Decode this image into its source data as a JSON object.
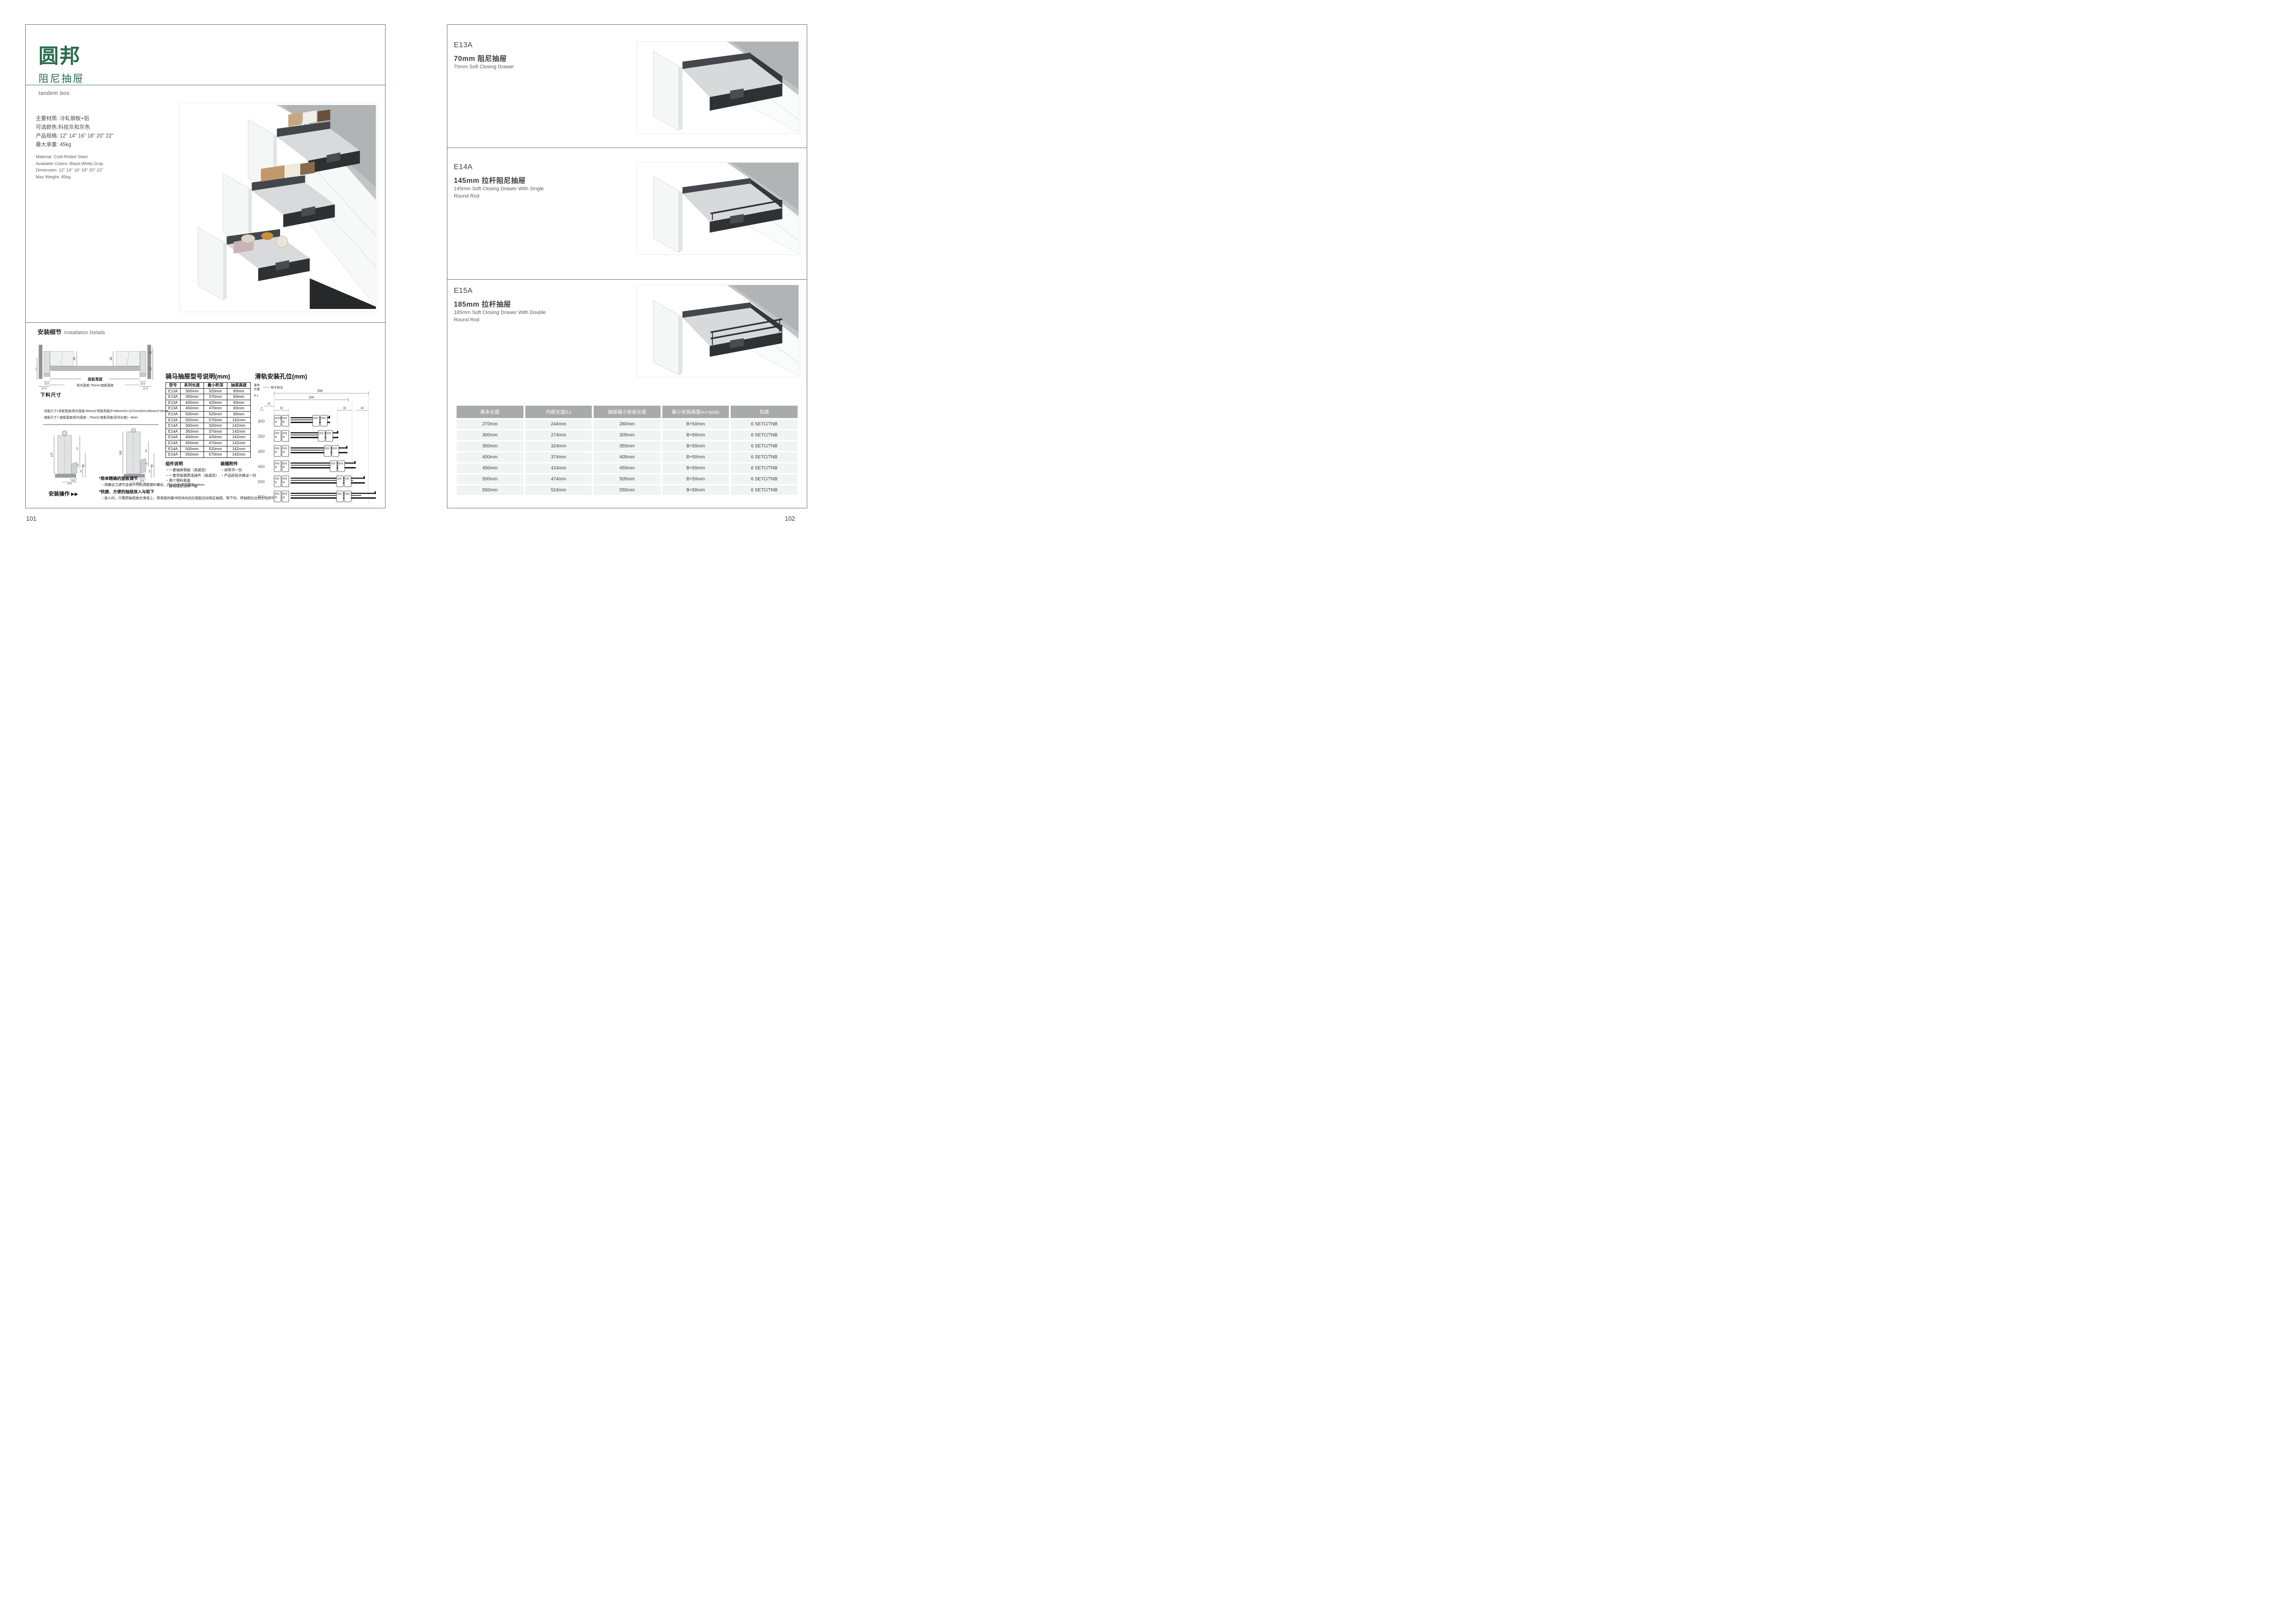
{
  "brand": {
    "name": "圆邦",
    "series": "阻尼抽屉",
    "series_en": "tandem box"
  },
  "left_page": {
    "page_number": "101",
    "specs_cn": [
      "主要材质: 冷轧钢板+铝",
      "可选颜色:科技灰和灰色",
      "产品规格: 12\" 14\" 16\" 18\" 20\" 22\"",
      "最大承重: 45kg"
    ],
    "specs_en": [
      "Material: Cold-Rolled Steel",
      "Available Colors: Black,White,Gray",
      "Dimension: 12\" 14\" 16\" 18\" 20\" 22\"",
      "Max Weight: 45kg"
    ],
    "install_title_cn": "安装细节",
    "install_title_en": "Installation Details",
    "dg1": {
      "w68a": "68",
      "w68b": "68",
      "h46": "46",
      "h32": "32",
      "h54": "54",
      "b165l": "16.5",
      "b375l": "37.5",
      "b165r": "16.5",
      "b375r": "37.5",
      "bottom_width": "底板宽度",
      "formula": "柜内宽度-75mm=底板宽度"
    },
    "cutting_title": "下料尺寸",
    "cutting_line1": "背板尺寸=背板宽度(柜内宽度-85mm)*背板高度(P=68mm/G=127mm/GH=180mm)*16mm",
    "cutting_line2": "底板尺寸＝底板宽度(柜内宽度－75mm)*底板深度(系列长度)－8mm",
    "dg2": {
      "h127": "127",
      "h77": "77",
      "h32a": "32",
      "h54a": "54",
      "h86a": "86",
      "b165a": "16.5",
      "b375a": "37.5",
      "h180": "180",
      "h57": "57",
      "h32b": "32",
      "h54b": "54",
      "h86b": "86",
      "b165b": "16.5",
      "b375b": "37.5"
    },
    "op_label": "安装操作",
    "op_arrows": "▶▶",
    "note1_head": "*简单精确的面板调节",
    "note1_body": "・用螺丝刀调节连接件内的调整塑料螺丝，可以左右调节面板±3mm",
    "note2_head": "*快捷、方便的抽屉放入与取下",
    "note2_body": "・放入时，只需把抽屉放在滑道上，将滑道的缓冲挡块向后拉就能自动锁定抽屉。取下时，将抽屉拉出向上抬即可。",
    "model_table": {
      "title": "骑马抽屉型号说明(mm)",
      "headers": [
        "型号",
        "系列长度",
        "最小柜深",
        "抽屉高度"
      ],
      "rows": [
        [
          "E13A",
          "300mm",
          "320mm",
          "83mm"
        ],
        [
          "E13A",
          "350mm",
          "370mm",
          "83mm"
        ],
        [
          "E13A",
          "400mm",
          "420mm",
          "83mm"
        ],
        [
          "E13A",
          "450mm",
          "470mm",
          "83mm"
        ],
        [
          "E13A",
          "500mm",
          "520mm",
          "83mm"
        ],
        [
          "E13A",
          "550mm",
          "570mm",
          "142mm"
        ],
        [
          "E14A",
          "300mm",
          "320mm",
          "142mm"
        ],
        [
          "E14A",
          "350mm",
          "370mm",
          "142mm"
        ],
        [
          "E14A",
          "400mm",
          "420mm",
          "142mm"
        ],
        [
          "E14A",
          "450mm",
          "470mm",
          "142mm"
        ],
        [
          "E14A",
          "500mm",
          "520mm",
          "142mm"
        ],
        [
          "E14A",
          "550mm",
          "570mm",
          "142mm"
        ]
      ]
    },
    "components_title": "组件说明",
    "components": [
      "・一套抽屉侧板（高或低）",
      "・一套背板钢质连接件（高或低）",
      "・两个塑料侧盖",
      "・静音阻尼滑轨一套"
    ],
    "accessories_title": "装箱附件",
    "accessories": [
      "・说明书一份",
      "・产品检验合格证一份"
    ],
    "rail": {
      "title": "滑轨安装孔位(mm)",
      "basic1": "基本",
      "basic2": "长度",
      "nl": "N L",
      "front_edge": "柜子前沿",
      "d256": "256",
      "d224": "224",
      "d37": "37",
      "d9": "9",
      "d32a": "32",
      "d32b": "32",
      "d32c": "32",
      "lengths": [
        "300",
        "350",
        "400",
        "450",
        "500",
        "550"
      ]
    }
  },
  "right_page": {
    "page_number": "102",
    "products": [
      {
        "code": "E13A",
        "cn": "70mm 阻尼抽屉",
        "en": "70mm Soft Closing Drawer"
      },
      {
        "code": "E14A",
        "cn": "145mm 拉杆阻尼抽屉",
        "en": "145mm Soft Closing Drawer With Single Round Rod"
      },
      {
        "code": "E15A",
        "cn": "185mm 拉杆抽屉",
        "en": "185mm Soft Closing Drawer With Double Round Rod"
      }
    ],
    "size_table": {
      "headers": [
        "基本长度",
        "内部长度(L)",
        "抽屉最小安装长度",
        "最小安装高度",
        "包装"
      ],
      "header4_suffix": "(B=产品高度)",
      "rows": [
        [
          "270mm",
          "244mm",
          "280mm",
          "B+50mm",
          "6 SETC/TNB"
        ],
        [
          "300mm",
          "274mm",
          "305mm",
          "B+50mm",
          "6 SETC/TNB"
        ],
        [
          "350mm",
          "324mm",
          "355mm",
          "B+50mm",
          "6 SETC/TNB"
        ],
        [
          "400mm",
          "374mm",
          "405mm",
          "B+50mm",
          "6 SETC/TNB"
        ],
        [
          "450mm",
          "424mm",
          "455mm",
          "B+50mm",
          "6 SETC/TNB"
        ],
        [
          "500mm",
          "474mm",
          "505mm",
          "B+50mm",
          "6 SETC/TNB"
        ],
        [
          "550mm",
          "524mm",
          "555mm",
          "B+50mm",
          "6 SETC/TNB"
        ]
      ]
    }
  },
  "colors": {
    "brand_green": "#276b4d",
    "frame": "#5e7468",
    "table_header_bg": "#a8abac",
    "table_row_bg": "#f2f3f3"
  }
}
